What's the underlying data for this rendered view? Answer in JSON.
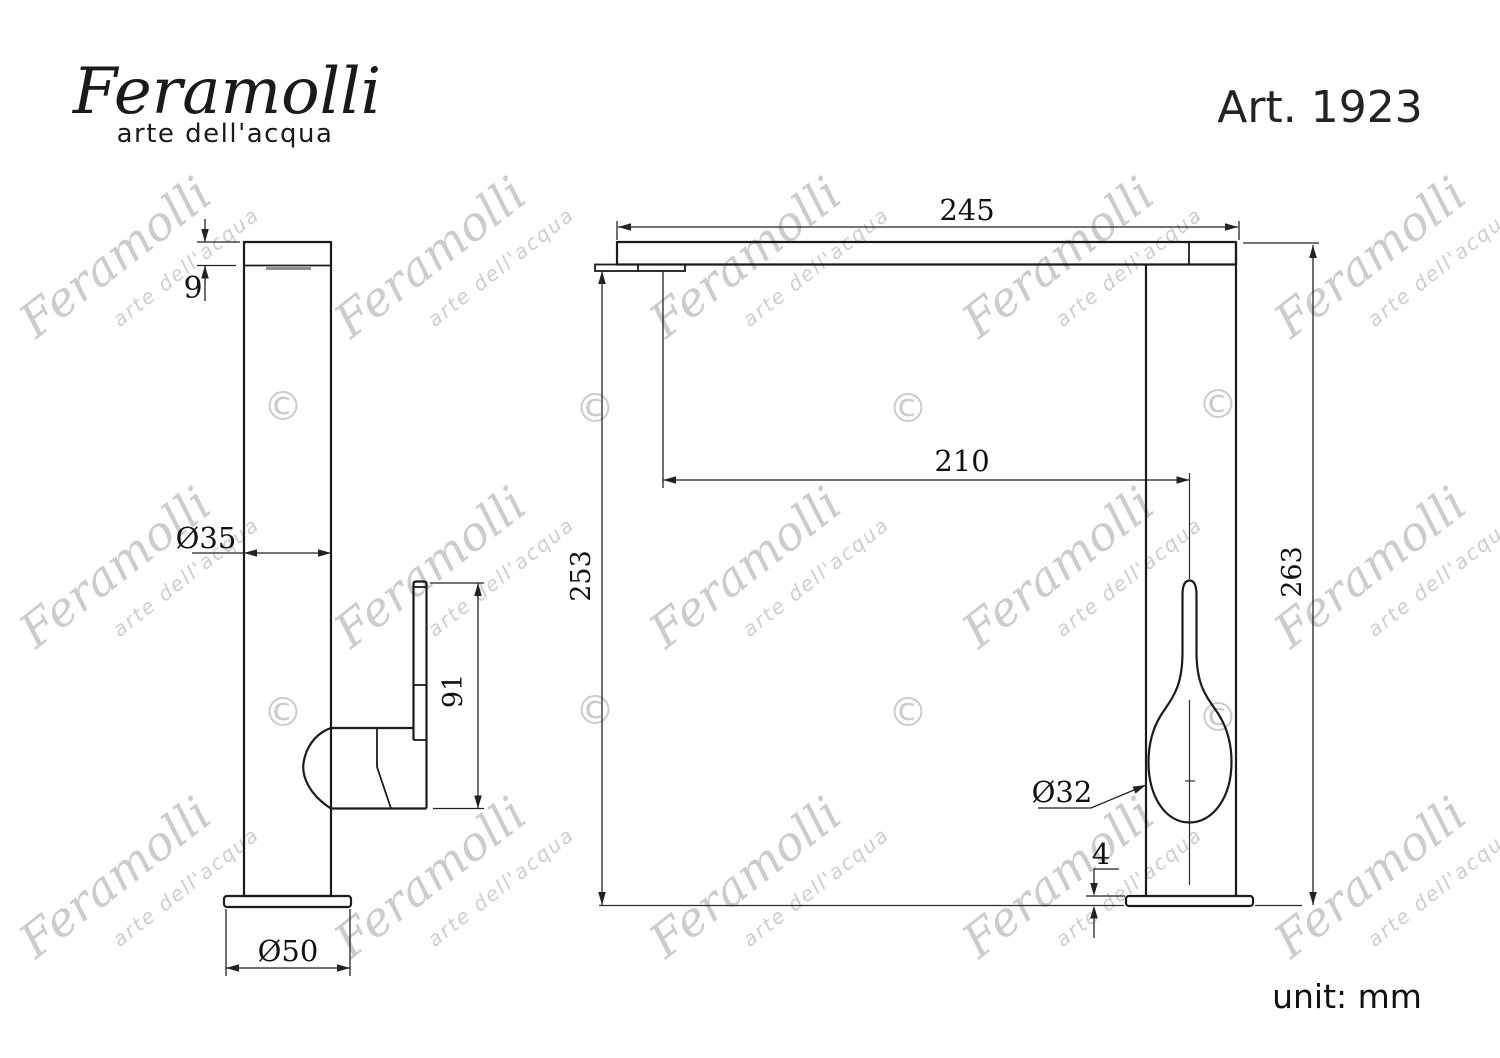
{
  "brand": {
    "logo": "Feramolli",
    "tagline": "arte dell'acqua"
  },
  "header": {
    "article": "Art. 1923"
  },
  "footer": {
    "unit": "unit: mm"
  },
  "watermark": {
    "line1": "Feramolli",
    "line2": "arte dell'acqua",
    "symbol": "©",
    "color": "#c7c7c7"
  },
  "drawing": {
    "type": "technical-drawing",
    "subject": "kitchen mixer tap, two orthographic views",
    "unit": "mm",
    "side_view": {
      "dims": {
        "spout_thickness": "9",
        "column_diameter": "Ø35",
        "handle_height": "91",
        "base_diameter": "Ø50"
      }
    },
    "front_view": {
      "dims": {
        "spout_length": "245",
        "spout_reach": "210",
        "underside_height": "253",
        "total_height": "263",
        "handle_diameter": "Ø32",
        "base_thickness": "4"
      }
    }
  }
}
